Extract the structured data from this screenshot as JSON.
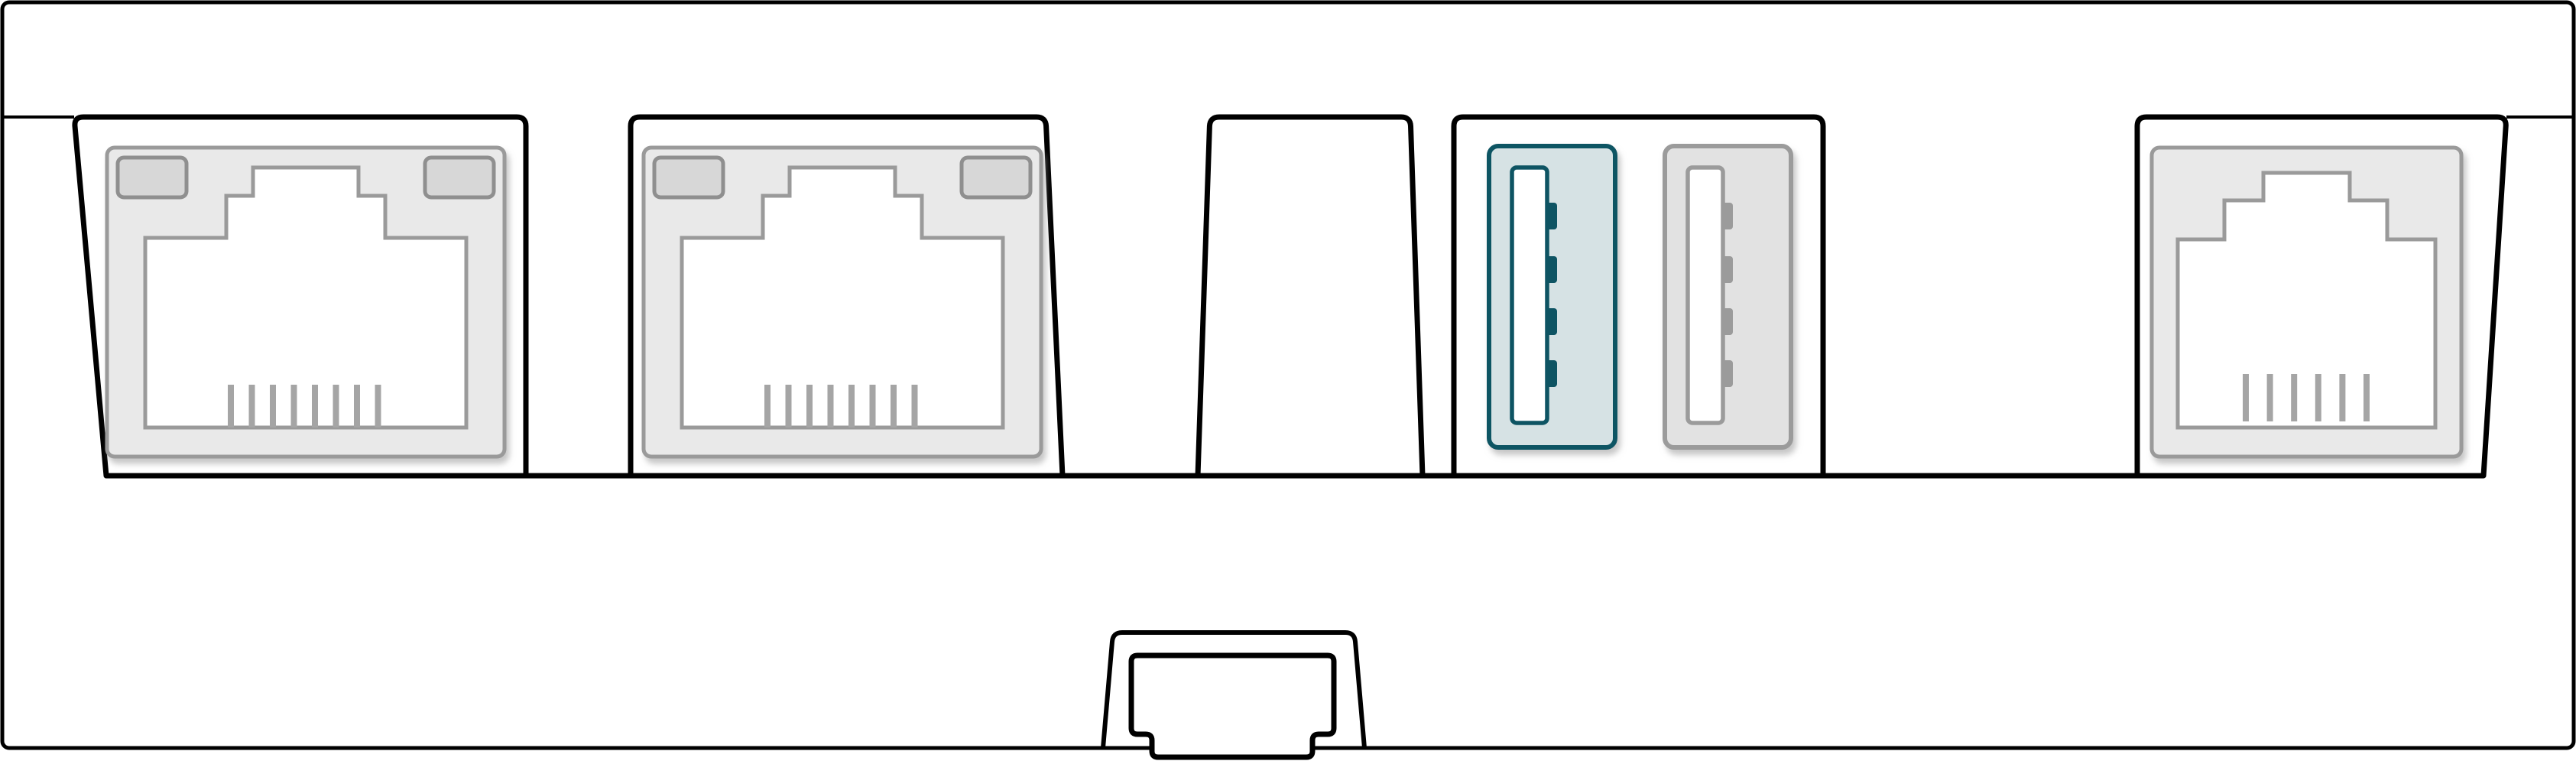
{
  "diagram": {
    "title": "Device rear panel connector diagram",
    "background": "#ffffff"
  },
  "colors": {
    "outline": "#000000",
    "port_fill": "#e9e9e9",
    "port_stroke": "#9a9a9a",
    "led_fill": "#d7d7d7",
    "led_stroke": "#8f8f8f",
    "pin": "#a5a5a5",
    "accent": "#0e5463",
    "accent_fill": "#d6e2e4",
    "usb_gray_fill": "#e2e2e2",
    "usb_gray_stroke": "#9b9b9b",
    "shadow": "#999999"
  },
  "panel": {
    "label": "Rear panel",
    "bays": [
      {
        "label": "Ethernet port bay 1"
      },
      {
        "label": "Ethernet port bay 2"
      },
      {
        "label": "Empty bay"
      },
      {
        "label": "USB port bay"
      },
      {
        "label": "Phone line port bay"
      }
    ]
  },
  "ports": [
    {
      "id": "ethernet-port-1",
      "type": "rj45-ethernet",
      "label": "Ethernet port 1",
      "pins": 8,
      "leds": 2,
      "highlighted": false
    },
    {
      "id": "ethernet-port-2",
      "type": "rj45-ethernet",
      "label": "Ethernet port 2",
      "pins": 8,
      "leds": 2,
      "highlighted": false
    },
    {
      "id": "usb-port-1",
      "type": "usb-a",
      "label": "USB port 1 (highlighted)",
      "contacts": 4,
      "highlighted": true
    },
    {
      "id": "usb-port-2",
      "type": "usb-a",
      "label": "USB port 2",
      "contacts": 4,
      "highlighted": false
    },
    {
      "id": "phone-port",
      "type": "rj11",
      "label": "Phone line port",
      "pins": 6,
      "leds": 0,
      "highlighted": false
    }
  ],
  "bottom_connector": {
    "id": "expansion-connector",
    "label": "Bottom docking connector"
  }
}
